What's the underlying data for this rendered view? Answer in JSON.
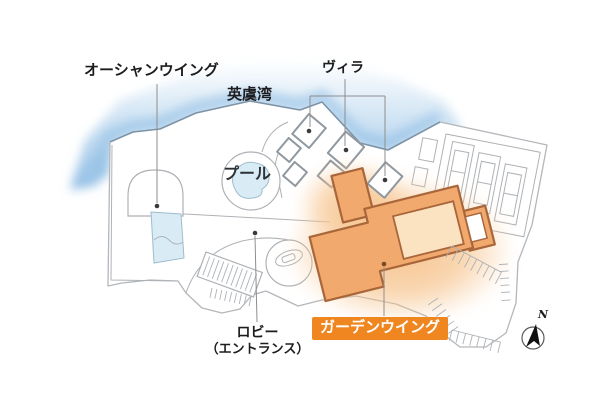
{
  "map": {
    "area_labels": {
      "ocean_wing": "オーシャンウイング",
      "ago_bay": "英虞湾",
      "villa": "ヴィラ",
      "pool": "プール",
      "lobby": "ロビー",
      "lobby_sub": "（エントランス）",
      "garden_wing": "ガーデンウイング"
    },
    "compass": {
      "north": "N"
    },
    "colors": {
      "water_light": "#eaf3fb",
      "water_mid": "#bcd8ef",
      "water_deep": "#8fbde4",
      "coast_stroke": "#7d93a6",
      "land_fill": "#ffffff",
      "land_stroke": "#b3b7bb",
      "detail_stroke": "#aeb2b6",
      "building_stroke": "#8f979f",
      "pool_fill": "#d9ecf6",
      "pool_stroke": "#9fbccd",
      "orange_fill": "#f2a96d",
      "orange_stroke": "#a8663a",
      "courtyard_fill": "#fbe3c1",
      "glow": "#f6c38c",
      "label_text": "#1d1d1f",
      "leader": "#8e8e8e",
      "dot": "#3a3a3a",
      "highlight_bg": "#f0861f",
      "highlight_text": "#ffffff",
      "compass_stroke": "#5a5a5a",
      "compass_fill": "#111111"
    }
  }
}
